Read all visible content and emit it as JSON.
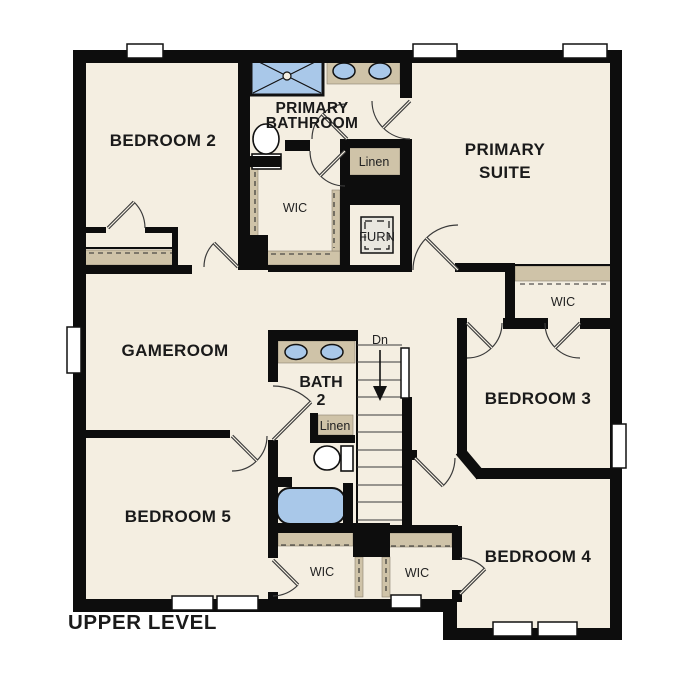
{
  "plan": {
    "level_title": "UPPER LEVEL",
    "rooms": {
      "bedroom2": "BEDROOM 2",
      "primary_bathroom": [
        "PRIMARY",
        "BATHROOM"
      ],
      "primary_suite": [
        "PRIMARY",
        "SUITE"
      ],
      "gameroom": "GAMEROOM",
      "bedroom3": "BEDROOM 3",
      "bedroom4": "BEDROOM 4",
      "bedroom5": "BEDROOM 5",
      "bath2": [
        "BATH",
        "2"
      ]
    },
    "closets": {
      "linen_primary": "Linen",
      "linen_bath2": "Linen",
      "wic_primary": "WIC",
      "wic_bedroom3": "WIC",
      "wic_bedroom5": "WIC",
      "wic_bedroom4": "WIC"
    },
    "utility": {
      "furnace": "FURN",
      "stairs_down": "Dn"
    },
    "colors": {
      "background": "#ffffff",
      "floor": "#f4eee1",
      "wall": "#0d0d0d",
      "casework": "#cfc3a8",
      "fixture_blue": "#a9c8e9",
      "text": "#1a1a1a"
    }
  }
}
